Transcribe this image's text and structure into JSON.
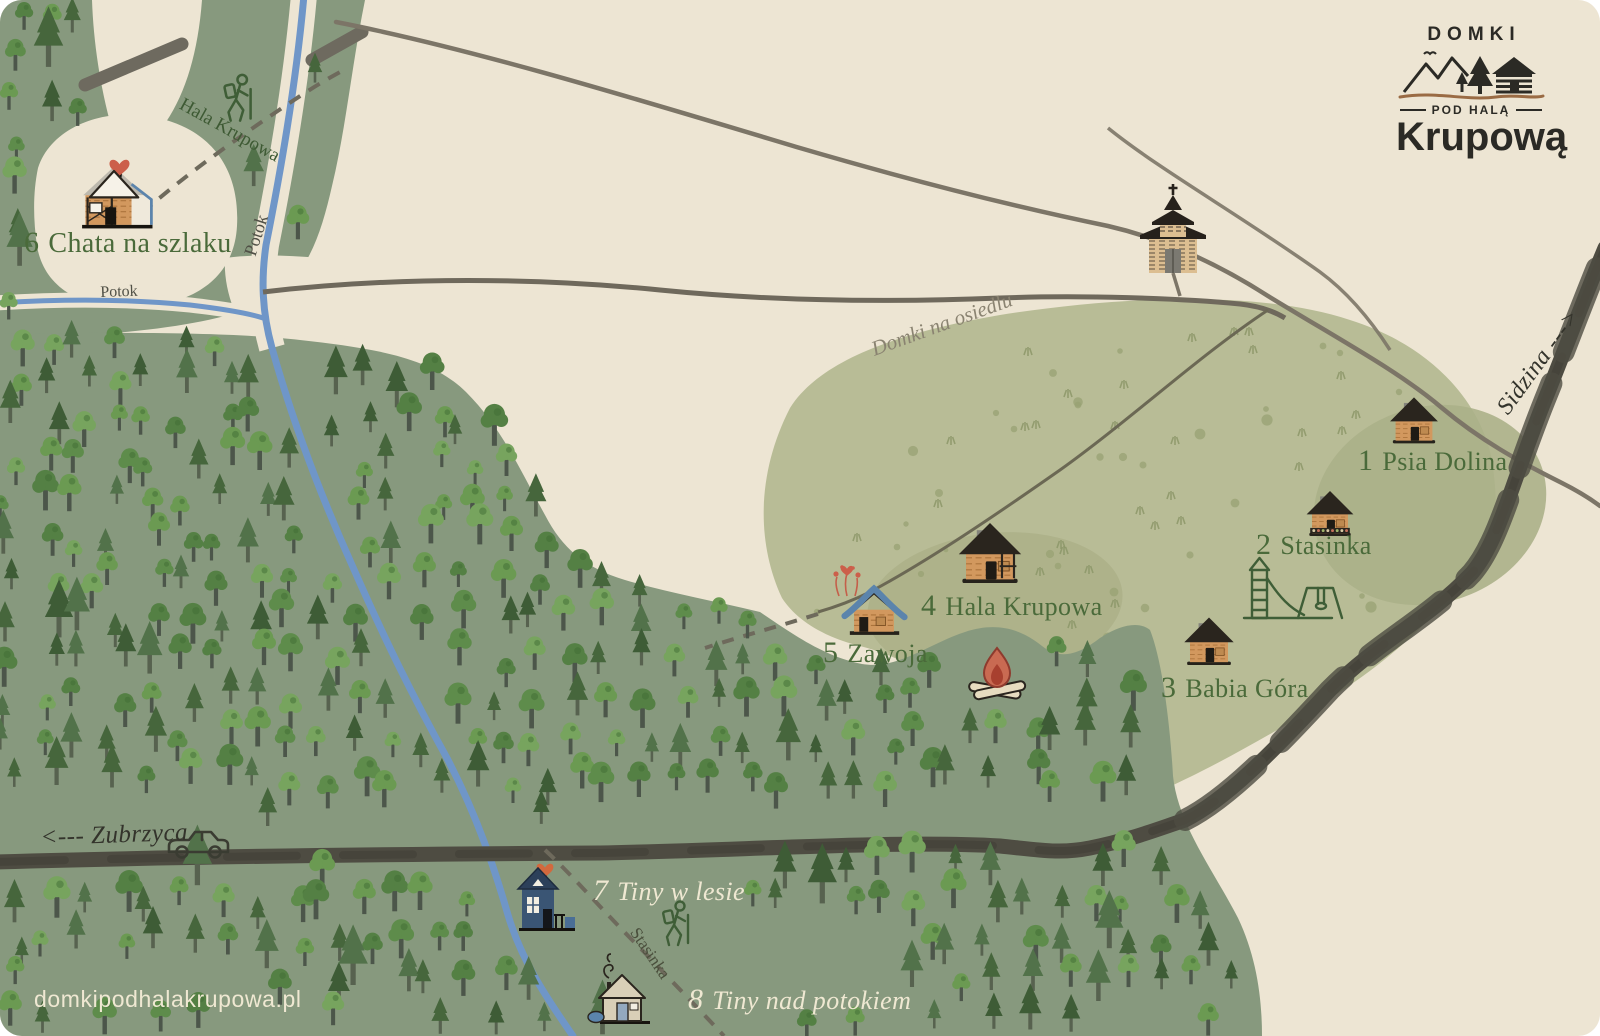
{
  "brand": {
    "top": "DOMKI",
    "middle": "POD HALĄ",
    "bottom": "Krupową"
  },
  "website": {
    "label": "domkipodhalakrupowa.pl"
  },
  "locations": [
    {
      "number": "1",
      "name": "Psia Dolina"
    },
    {
      "number": "2",
      "name": "Stasinka"
    },
    {
      "number": "3",
      "name": "Babia Góra"
    },
    {
      "number": "4",
      "name": "Hala Krupowa"
    },
    {
      "number": "5",
      "name": "Zawoja"
    },
    {
      "number": "6",
      "name": "Chata na szlaku"
    },
    {
      "number": "7",
      "name": "Tiny w lesie"
    },
    {
      "number": "8",
      "name": "Tiny nad potokiem"
    }
  ],
  "map_labels": {
    "road_west": "<--- Zubrzyca",
    "road_east": "Sidzina --->",
    "stream_vertical": "Potok",
    "stream_horizontal": "Potok",
    "trail_north": "Hala Krupowa",
    "trail_south": "Stasinka",
    "area_meadow": "Domki na osiedlu"
  },
  "markers": [
    {
      "name": "cabin-psia-dolina",
      "type": "cabin",
      "x": 1414,
      "y": 425,
      "s": 0.92,
      "interactable": true
    },
    {
      "name": "cabin-stasinka",
      "type": "cabinFlowers",
      "x": 1330,
      "y": 518,
      "s": 0.9,
      "interactable": true
    },
    {
      "name": "cabin-babia-gora",
      "type": "cabin",
      "x": 1209,
      "y": 646,
      "s": 0.95,
      "interactable": true
    },
    {
      "name": "cabin-hala-krupowa",
      "type": "cabinPorch",
      "x": 990,
      "y": 559,
      "s": 1.2,
      "interactable": true
    },
    {
      "name": "cabin-zawoja",
      "type": "cabinBlue",
      "x": 874,
      "y": 616,
      "s": 1.05,
      "interactable": true
    },
    {
      "name": "cabin-chata-na-szlaku",
      "type": "cabinAFrame",
      "x": 114,
      "y": 204,
      "s": 1.1,
      "interactable": true
    },
    {
      "name": "cabin-tiny-w-lesie",
      "type": "tinyBlue",
      "x": 538,
      "y": 906,
      "s": 1.0,
      "interactable": true
    },
    {
      "name": "cabin-tiny-nad-potokiem",
      "type": "tinyCream",
      "x": 622,
      "y": 1002,
      "s": 1.0,
      "interactable": true
    },
    {
      "name": "church",
      "type": "church",
      "x": 1173,
      "y": 231,
      "s": 1.0,
      "interactable": false
    },
    {
      "name": "campfire",
      "type": "fire",
      "x": 997,
      "y": 678,
      "s": 1.0,
      "interactable": false
    },
    {
      "name": "playground",
      "type": "playground",
      "x": 1288,
      "y": 594,
      "s": 1.0,
      "interactable": false
    },
    {
      "name": "hiker-trail-north",
      "type": "hiker",
      "x": 238,
      "y": 108,
      "s": 1.05,
      "interactable": false
    },
    {
      "name": "hiker-trail-south",
      "type": "hiker",
      "x": 676,
      "y": 933,
      "s": 1.0,
      "interactable": false
    },
    {
      "name": "car",
      "type": "car",
      "x": 198,
      "y": 845,
      "s": 1.0,
      "interactable": false
    },
    {
      "name": "flowers-zawoja",
      "type": "flowers",
      "x": 847,
      "y": 586,
      "s": 1.0,
      "interactable": false
    }
  ],
  "palette": {
    "background": "#EDE5D3",
    "forest": "#87997E",
    "meadow": "#B8BC96",
    "meadow_dark": "#ABB088",
    "road_dark": "#4E4C42",
    "road_thin": "#7C7567",
    "stream": "#6F96C8",
    "label_green": "#4A6A3A",
    "label_cream": "#EFE8D2",
    "accent_red": "#CC5F4A",
    "cabin_wood": "#D2985E",
    "roof_dark": "#2A251E",
    "cabin_blue": "#3A5574"
  }
}
